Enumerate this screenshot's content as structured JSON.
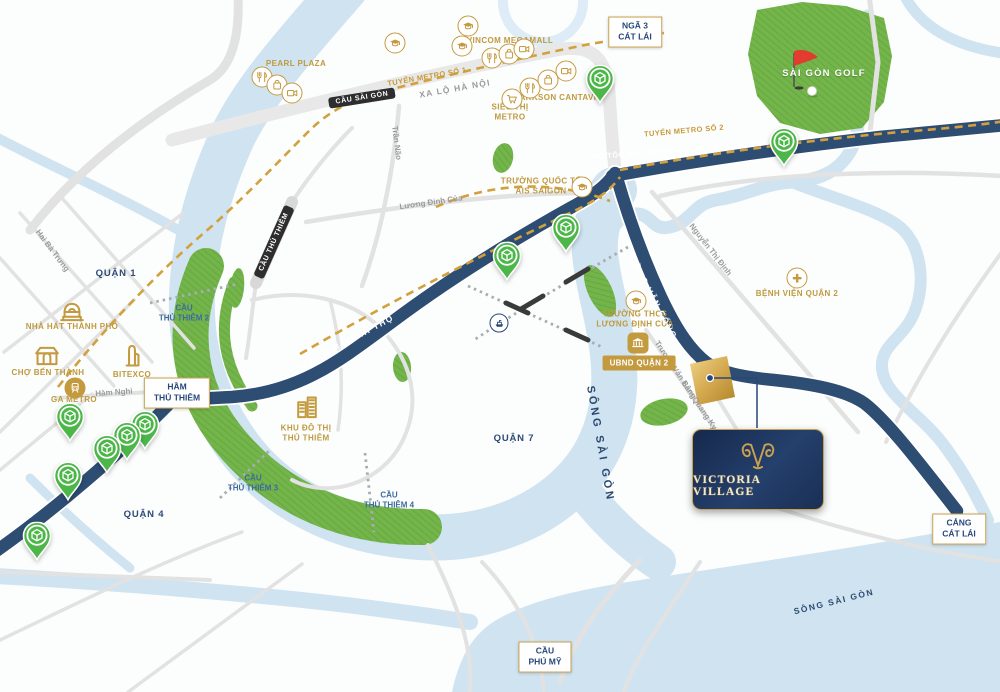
{
  "project_card": {
    "brand": "VICTORIA VILLAGE"
  },
  "colors": {
    "gold": "#bf9a3f",
    "navy_road": "#2e4d73",
    "river": "#cfe3f1",
    "green": "#74b54b",
    "pin_green": "#4cb648",
    "card_navy": "#1a2e55",
    "metro_gold": "#d2a03c"
  },
  "map": {
    "labels": [
      {
        "name": "label-pearl-plaza",
        "cls": "gold",
        "x": 296,
        "y": 64,
        "text": "PEARL PLAZA"
      },
      {
        "name": "label-vincom-megamall",
        "cls": "gold",
        "x": 510,
        "y": 41,
        "text": "VINCOM MEGAMALL"
      },
      {
        "name": "label-parkson-cantavil",
        "cls": "gold",
        "x": 558,
        "y": 98,
        "text": "PARKSON CANTAVIL"
      },
      {
        "name": "label-sieu-thi-metro",
        "cls": "gold",
        "x": 510,
        "y": 113,
        "lines": [
          "SIÊU THỊ",
          "METRO"
        ]
      },
      {
        "name": "label-ais-saigon",
        "cls": "gold",
        "x": 541,
        "y": 187,
        "lines": [
          "TRƯỜNG QUỐC TẾ",
          "AIS SAIGON"
        ]
      },
      {
        "name": "label-thcs-luong-dinh-cua",
        "cls": "gold",
        "x": 635,
        "y": 320,
        "lines": [
          "TRƯỜNG THCS",
          "LƯƠNG ĐỊNH CỦA"
        ]
      },
      {
        "name": "label-benh-vien-quan-2",
        "cls": "gold",
        "x": 797,
        "y": 294,
        "text": "BỆNH VIỆN QUẬN 2"
      },
      {
        "name": "label-nha-hat-thanh-pho",
        "cls": "gold",
        "x": 72,
        "y": 327,
        "text": "NHÀ HÁT THÀNH PHỐ"
      },
      {
        "name": "label-cho-ben-thanh",
        "cls": "gold",
        "x": 48,
        "y": 373,
        "text": "CHỢ BẾN THÀNH"
      },
      {
        "name": "label-bitexco",
        "cls": "gold",
        "x": 132,
        "y": 375,
        "text": "BITEXCO"
      },
      {
        "name": "label-ga-metro",
        "cls": "gold",
        "x": 74,
        "y": 400,
        "text": "GA METRO"
      },
      {
        "name": "label-khu-do-thi-thu-thiem",
        "cls": "gold",
        "x": 306,
        "y": 434,
        "lines": [
          "KHU ĐÔ THỊ",
          "THỦ THIÊM"
        ]
      },
      {
        "name": "label-sai-gon-golf",
        "cls": "golf",
        "x": 824,
        "y": 74,
        "text": "SÀI GÒN GOLF"
      },
      {
        "name": "label-quan-1",
        "cls": "area",
        "x": 116,
        "y": 274,
        "text": "QUẬN 1"
      },
      {
        "name": "label-quan-4",
        "cls": "area",
        "x": 144,
        "y": 515,
        "text": "QUẬN 4"
      },
      {
        "name": "label-quan-7",
        "cls": "area",
        "x": 514,
        "y": 439,
        "text": "QUẬN 7"
      },
      {
        "name": "street-hai-ba-trung",
        "cls": "street",
        "x": 52,
        "y": 251,
        "rot": 53,
        "text": "Hai Bà Trưng"
      },
      {
        "name": "street-ham-nghi",
        "cls": "street",
        "x": 114,
        "y": 393,
        "rot": -4,
        "text": "Hàm Nghi"
      },
      {
        "name": "street-tran-nao",
        "cls": "street",
        "x": 396,
        "y": 143,
        "rot": 83,
        "text": "Trần Não"
      },
      {
        "name": "street-luong-dinh-cua",
        "cls": "street",
        "x": 431,
        "y": 203,
        "rot": -8,
        "text": "Lương Định Của"
      },
      {
        "name": "street-nguyen-thi-dinh",
        "cls": "street",
        "x": 710,
        "y": 250,
        "rot": 52,
        "text": "Nguyễn Thị Định"
      },
      {
        "name": "street-truong-van-bang",
        "cls": "street",
        "x": 675,
        "y": 370,
        "rot": 56,
        "text": "Trương Văn Bang"
      },
      {
        "name": "street-lam-quang-ky",
        "cls": "street",
        "x": 699,
        "y": 406,
        "rot": 56,
        "text": "Lâm Quang Ky"
      },
      {
        "name": "road-xa-lo-ha-noi",
        "cls": "hwy",
        "x": 455,
        "y": 89,
        "rot": -10,
        "text": "XA LỘ HÀ NỘI"
      },
      {
        "name": "road-mai-chi-tho",
        "cls": "roadwhite",
        "x": 345,
        "y": 343,
        "rot": -28,
        "text": "ĐẠI LỘ MAI CHÍ THỌ"
      },
      {
        "name": "road-cao-toc",
        "cls": "roadwhite sm",
        "x": 689,
        "y": 149,
        "rot": -5,
        "text": "CAO TỐC HỒ CHÍ MINH - LONG THÀNH - DẦU GIÂY"
      },
      {
        "name": "road-dong-van-cong",
        "cls": "roadwhite",
        "x": 653,
        "y": 298,
        "rot": 62,
        "text": "ĐỒNG VĂN CỐNG"
      },
      {
        "name": "metro-line-1-label",
        "cls": "metro",
        "x": 427,
        "y": 77,
        "rot": -10,
        "text": "TUYẾN METRO SỐ 1"
      },
      {
        "name": "metro-line-2-label",
        "cls": "metro",
        "x": 684,
        "y": 131,
        "rot": -5,
        "text": "TUYẾN METRO SỐ 2"
      },
      {
        "name": "bridge-thu-thiem-2-label",
        "cls": "bluebridge",
        "x": 184,
        "y": 314,
        "lines": [
          "CẦU",
          "THỦ THIÊM 2"
        ]
      },
      {
        "name": "bridge-thu-thiem-3-label",
        "cls": "bluebridge",
        "x": 253,
        "y": 484,
        "lines": [
          "CẦU",
          "THỦ THIÊM 3"
        ]
      },
      {
        "name": "bridge-thu-thiem-4-label",
        "cls": "bluebridge",
        "x": 389,
        "y": 501,
        "lines": [
          "CẦU",
          "THỦ THIÊM 4"
        ]
      },
      {
        "name": "river-song-sai-gon-mid",
        "cls": "river",
        "x": 600,
        "y": 444,
        "rot": 80,
        "text": "SÔNG SÀI GÒN"
      },
      {
        "name": "river-song-sai-gon-bottom",
        "cls": "river sm",
        "x": 834,
        "y": 602,
        "rot": -14,
        "text": "SÔNG SÀI GÒN"
      }
    ],
    "bridge_tags": [
      {
        "name": "tag-cau-sai-gon",
        "x": 362,
        "y": 98,
        "rot": -9,
        "text": "CẦU SÀI GÒN"
      },
      {
        "name": "tag-cau-thu-thiem",
        "x": 274,
        "y": 242,
        "rot": -66,
        "text": "CẦU THỦ THIÊM"
      }
    ],
    "callout_boxes": [
      {
        "name": "callout-nga-3-cat-lai",
        "x": 635,
        "y": 32,
        "lines": [
          "NGÃ 3",
          "CÁT LÁI"
        ]
      },
      {
        "name": "callout-ham-thu-thiem",
        "x": 177,
        "y": 393,
        "lines": [
          "HẦM",
          "THỦ THIÊM"
        ]
      },
      {
        "name": "callout-cau-phu-my",
        "x": 545,
        "y": 657,
        "lines": [
          "CẦU",
          "PHÚ MỸ"
        ]
      },
      {
        "name": "callout-cang-cat-lai",
        "x": 959,
        "y": 529,
        "lines": [
          "CẢNG",
          "CÁT LÁI"
        ]
      }
    ],
    "badges": [
      {
        "name": "badge-ubnd-quan-2",
        "x": 639,
        "y": 363,
        "text": "UBND QUẬN 2"
      }
    ],
    "icon_markers": [
      {
        "name": "restaurant-icon",
        "icon": "restaurant",
        "variant": "circle",
        "x": 262,
        "y": 77
      },
      {
        "name": "shopping-icon",
        "icon": "shopping",
        "variant": "circle",
        "x": 277,
        "y": 85
      },
      {
        "name": "cinema-icon",
        "icon": "cinema",
        "variant": "circle",
        "x": 292,
        "y": 93
      },
      {
        "name": "restaurant-icon",
        "icon": "restaurant",
        "variant": "circle",
        "x": 492,
        "y": 58
      },
      {
        "name": "shopping-icon",
        "icon": "shopping",
        "variant": "circle",
        "x": 509,
        "y": 54
      },
      {
        "name": "cinema-icon",
        "icon": "cinema",
        "variant": "circle",
        "x": 524,
        "y": 49
      },
      {
        "name": "restaurant-icon",
        "icon": "restaurant",
        "variant": "circle",
        "x": 530,
        "y": 88
      },
      {
        "name": "shopping-icon",
        "icon": "shopping",
        "variant": "circle",
        "x": 548,
        "y": 80
      },
      {
        "name": "cinema-icon",
        "icon": "cinema",
        "variant": "circle",
        "x": 566,
        "y": 71
      },
      {
        "name": "supermarket-cart-icon",
        "icon": "cart",
        "variant": "circle",
        "x": 512,
        "y": 99
      },
      {
        "name": "school-icon",
        "icon": "grad",
        "variant": "circle",
        "x": 395,
        "y": 43
      },
      {
        "name": "school-icon",
        "icon": "grad",
        "variant": "circle",
        "x": 468,
        "y": 26
      },
      {
        "name": "school-icon",
        "icon": "grad",
        "variant": "circle",
        "x": 462,
        "y": 46
      },
      {
        "name": "school-icon",
        "icon": "grad",
        "variant": "circle",
        "x": 582,
        "y": 187
      },
      {
        "name": "school-icon",
        "icon": "grad",
        "variant": "circle",
        "x": 636,
        "y": 301
      },
      {
        "name": "hospital-cross-icon",
        "icon": "cross",
        "variant": "circle",
        "x": 797,
        "y": 278
      },
      {
        "name": "opera-house-icon",
        "icon": "theater",
        "variant": "bare",
        "x": 72,
        "y": 312
      },
      {
        "name": "market-icon",
        "icon": "market",
        "variant": "bare",
        "x": 47,
        "y": 356
      },
      {
        "name": "bitexco-tower-icon",
        "icon": "tower",
        "variant": "bare",
        "x": 132,
        "y": 356
      },
      {
        "name": "metro-train-icon",
        "icon": "train",
        "variant": "fill",
        "x": 75,
        "y": 388
      },
      {
        "name": "government-bank-icon",
        "icon": "bank",
        "variant": "rsq",
        "x": 638,
        "y": 343
      },
      {
        "name": "urban-area-icon",
        "icon": "city",
        "variant": "bare",
        "x": 307,
        "y": 407
      },
      {
        "name": "ferry-icon",
        "icon": "ship",
        "variant": "navy",
        "x": 499,
        "y": 323
      }
    ],
    "pins": [
      {
        "name": "amenity-pin",
        "x": 600,
        "y": 80
      },
      {
        "name": "amenity-pin",
        "x": 784,
        "y": 143
      },
      {
        "name": "amenity-pin",
        "x": 566,
        "y": 229
      },
      {
        "name": "amenity-pin",
        "x": 507,
        "y": 257
      },
      {
        "name": "amenity-pin",
        "x": 145,
        "y": 426
      },
      {
        "name": "amenity-pin",
        "x": 127,
        "y": 437
      },
      {
        "name": "amenity-pin",
        "x": 107,
        "y": 450
      },
      {
        "name": "amenity-pin",
        "x": 70,
        "y": 418
      },
      {
        "name": "amenity-pin",
        "x": 68,
        "y": 477
      },
      {
        "name": "amenity-pin",
        "x": 37,
        "y": 537
      }
    ]
  }
}
